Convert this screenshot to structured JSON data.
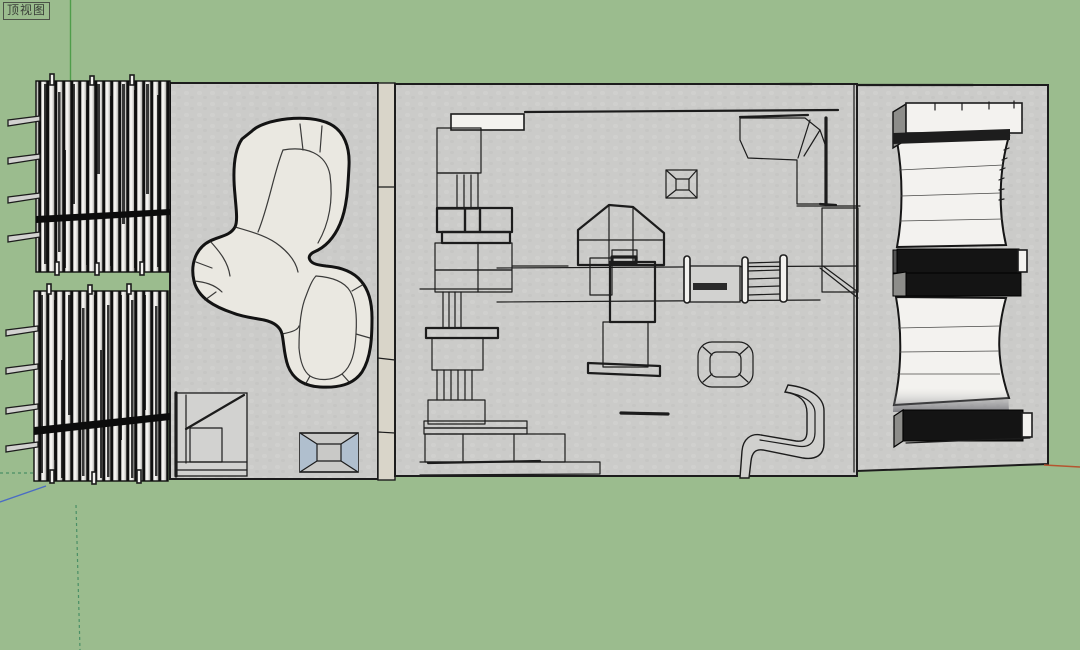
{
  "view": {
    "label": "顶视图"
  },
  "colors": {
    "bg": "#9bbc8e",
    "floor": "#cbcbc9",
    "floor_dot": "#d4d4d2",
    "strip": "#d9d5c9",
    "blob": "#eae8e1",
    "line": "#1c1c1c",
    "white": "#f3f2ef",
    "band_black": "#141414",
    "skylight": "#b0bfce",
    "metal": "#8d8d8a",
    "axis_green": "#4f9d4a",
    "axis_dash": "#4a8f66",
    "axis_blue": "#4a6cc4",
    "axis_red": "#b5552f"
  }
}
